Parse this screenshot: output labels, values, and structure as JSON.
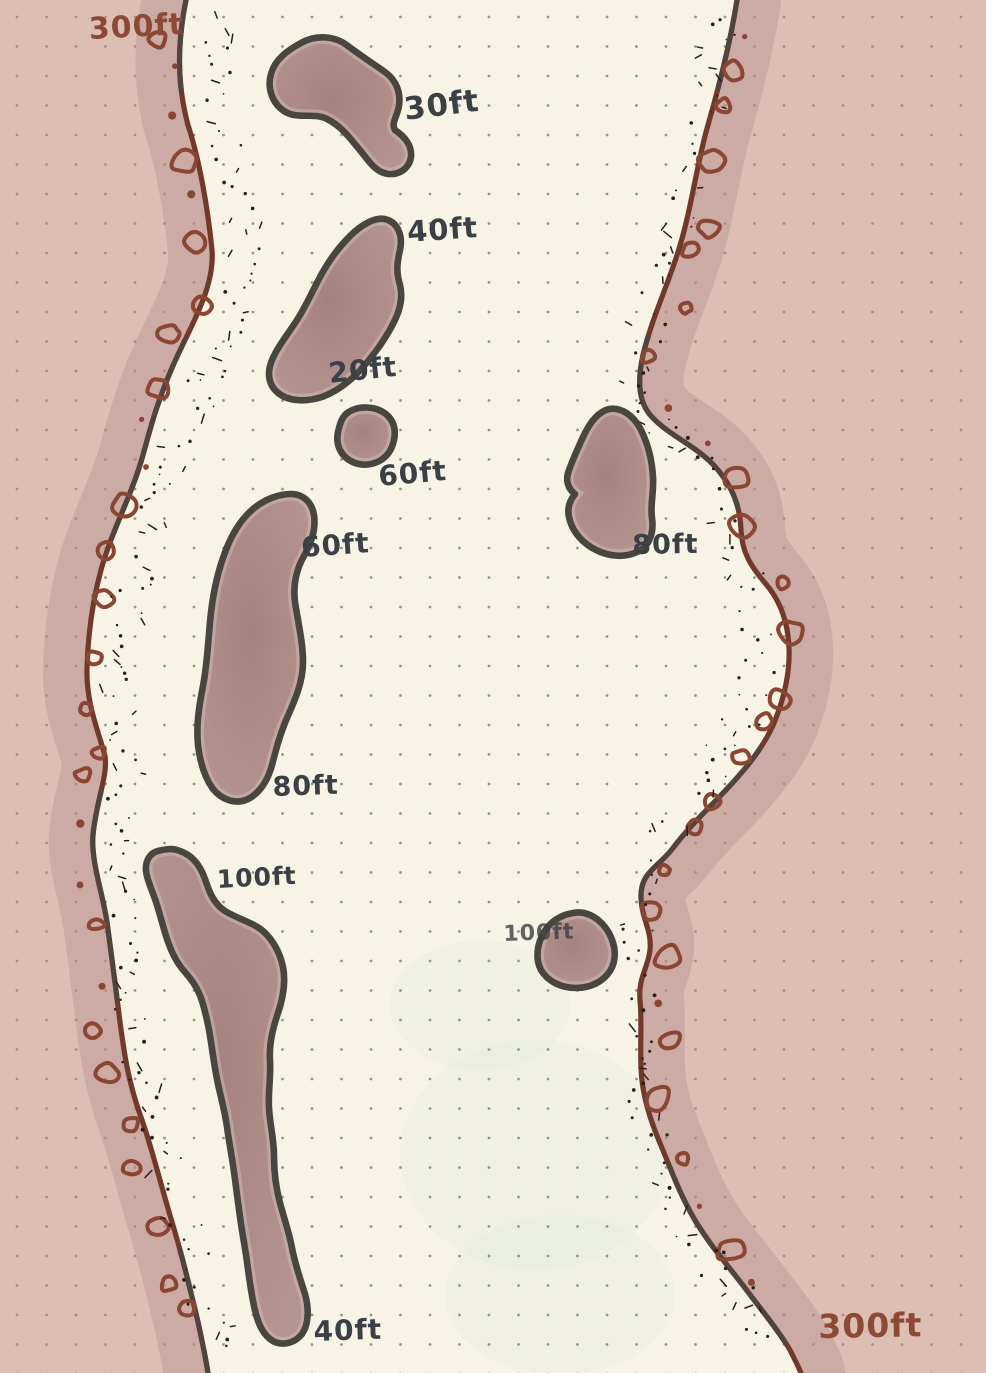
{
  "map_title": "Hand-drawn channel depth sketch",
  "palette": {
    "paper_water": "#f8f4e5",
    "land_pink": "#dcbeb3",
    "shore_wash": "#b2928e",
    "island_fill": "#b79794",
    "island_fill_dark": "#a5827e",
    "island_rim": "#d8c4bb",
    "island_outline": "#49453f",
    "shoreline_brown": "#70392b",
    "shoreline_dark": "#4a463f",
    "rock_brown": "#8a4533",
    "ink_dark": "#3a4045",
    "ink_brown": "#8c4936",
    "dot_water": "#8e9794",
    "dot_land": "#b28c80",
    "stipple": "#26211c",
    "bleed_through": "#e2ecde"
  },
  "depth_labels": [
    {
      "text": "300ft",
      "location": "top-left shore"
    },
    {
      "text": "30ft",
      "location": "north blob island"
    },
    {
      "text": "40ft",
      "location": "diagonal island, north tip"
    },
    {
      "text": "20ft",
      "location": "diagonal island, south tip"
    },
    {
      "text": "60ft",
      "location": "small mid island"
    },
    {
      "text": "60ft",
      "location": "long west island, north"
    },
    {
      "text": "80ft",
      "location": "east island"
    },
    {
      "text": "80ft",
      "location": "long west island, south"
    },
    {
      "text": "100ft",
      "location": "large southwest island"
    },
    {
      "text": "100ft",
      "location": "small southeast island"
    },
    {
      "text": "40ft",
      "location": "southwest island tail"
    },
    {
      "text": "300ft",
      "location": "bottom-right shore"
    }
  ]
}
